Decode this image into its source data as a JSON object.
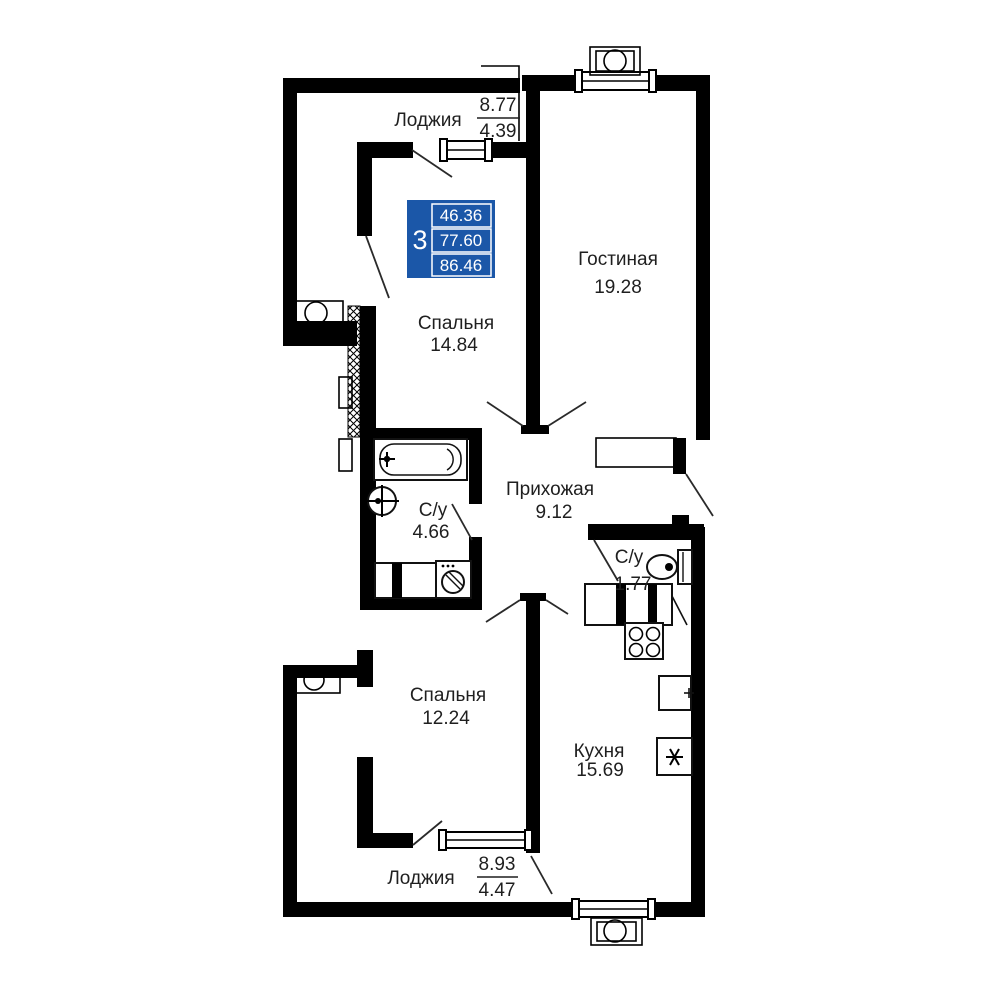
{
  "plan_title": "apartment-floor-plan",
  "rooms": {
    "living": {
      "label": "Гостиная",
      "area": "19.28"
    },
    "bedroom1": {
      "label": "Спальня",
      "area": "14.84"
    },
    "hallway": {
      "label": "Прихожая",
      "area": "9.12"
    },
    "bathroom": {
      "label": "С/у",
      "area": "4.66"
    },
    "wc": {
      "label": "С/у",
      "area": "1.77"
    },
    "kitchen": {
      "label": "Кухня",
      "area": "15.69"
    },
    "bedroom2": {
      "label": "Спальня",
      "area": "12.24"
    },
    "loggia_top": {
      "label": "Лоджия",
      "area_total": "8.77",
      "area_coef": "4.39"
    },
    "loggia_bottom": {
      "label": "Лоджия",
      "area_total": "8.93",
      "area_coef": "4.47"
    }
  },
  "info_box": {
    "rooms_count": "3",
    "living_area": "46.36",
    "usable_area": "77.60",
    "total_area": "86.46",
    "color": "#1b57a8"
  },
  "icons": [
    "bathtub-icon",
    "sink-icon",
    "washing-machine-icon",
    "toilet-icon",
    "stove-icon",
    "kitchen-sink-icon",
    "fridge-icon",
    "ac-unit-icon",
    "window-icon",
    "door-swing-icon"
  ]
}
